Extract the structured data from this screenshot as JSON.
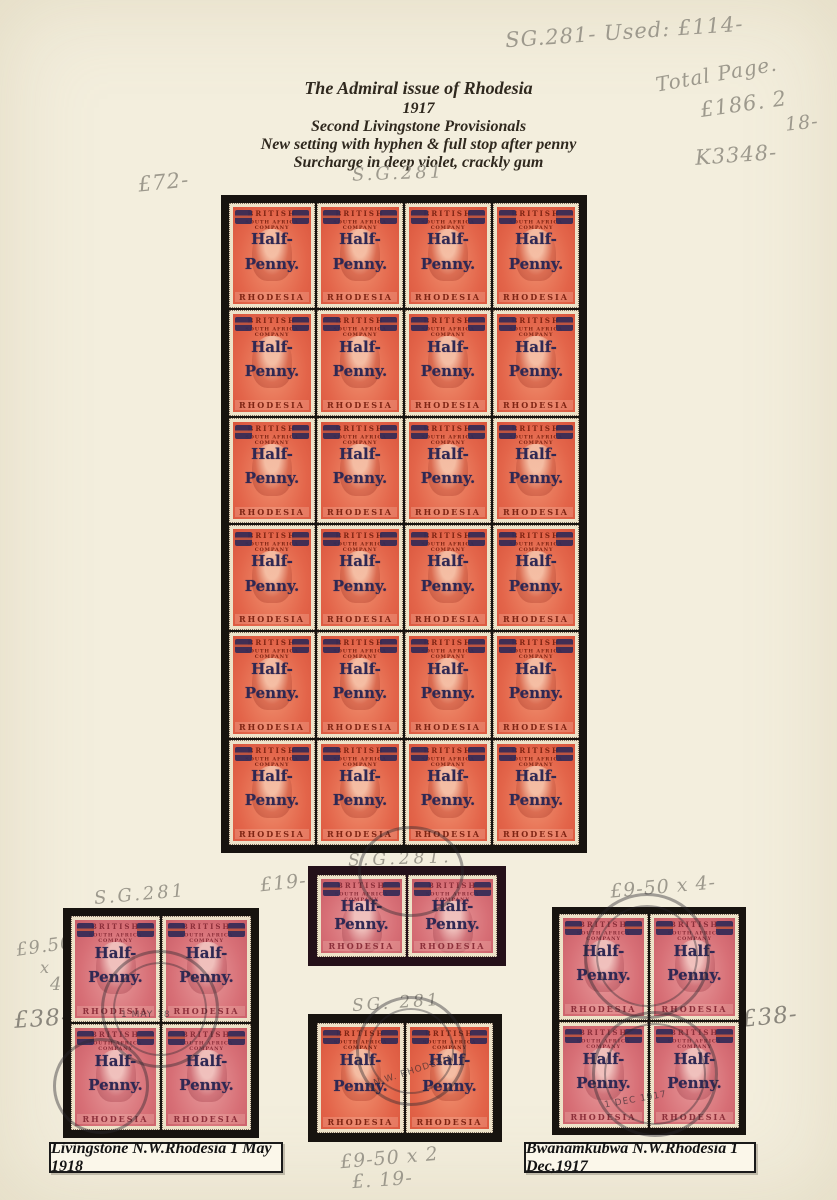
{
  "page": {
    "background_color": "#f3eedd",
    "title_lines": [
      "The Admiral issue of Rhodesia",
      "1917",
      "Second Livingstone Provisionals",
      "New setting with hyphen & full stop after penny",
      "Surcharge in deep violet, crackly gum"
    ]
  },
  "annotations": {
    "sg_used_price": "SG.281- Used: £114-",
    "total_page_label": "Total Page.",
    "total_page_amount": "£186. 2",
    "total_page_carry": "18-",
    "k_number": "K3348-",
    "main_block_price": "£72-",
    "main_block_sg": "S.G.281",
    "left_block_sg": "S.G.281",
    "left_block_unit_price": "£9.50",
    "left_block_times": "x",
    "left_block_qty": "4",
    "left_block_total": "£38-",
    "mid_top_sg": "S.G.281.",
    "mid_top_price": "£19-",
    "mid_bottom_sg": "SG. 281",
    "mid_bottom_calc": "£9-50 x 2",
    "mid_bottom_total": "£. 19-",
    "right_block_calc": "£9-50 x 4-",
    "right_block_total": "£38-"
  },
  "stamp": {
    "country_arc_top": "BRITISH",
    "country_arc_bottom": "SOUTH AFRICA COMPANY",
    "overprint_line1": "Half-",
    "overprint_line2": "Penny.",
    "country_band": "RHODESIA",
    "colors": {
      "mint_red": "#e3654a",
      "used_carmine": "#d76f76",
      "overprint_violet": "#2f2853",
      "mount_black": "#17130f"
    }
  },
  "postmarks": {
    "left_block_date": "1 MAY 18",
    "mid_bottom_text": "N.W. RHODESIA",
    "right_block_date": "1 DEC 1917"
  },
  "captions": {
    "left": "Livingstone N.W.Rhodesia 1 May 1918",
    "right": "Bwanamkubwa N.W.Rhodesia 1 Dec,1917"
  },
  "blocks": {
    "main": {
      "rows": 6,
      "cols": 4,
      "variant": "mint"
    },
    "left": {
      "rows": 2,
      "cols": 2,
      "variant": "used"
    },
    "mid_top": {
      "rows": 1,
      "cols": 2,
      "variant": "used"
    },
    "mid_bottom": {
      "rows": 1,
      "cols": 2,
      "variant": "mint"
    },
    "right": {
      "rows": 2,
      "cols": 2,
      "variant": "used"
    }
  }
}
